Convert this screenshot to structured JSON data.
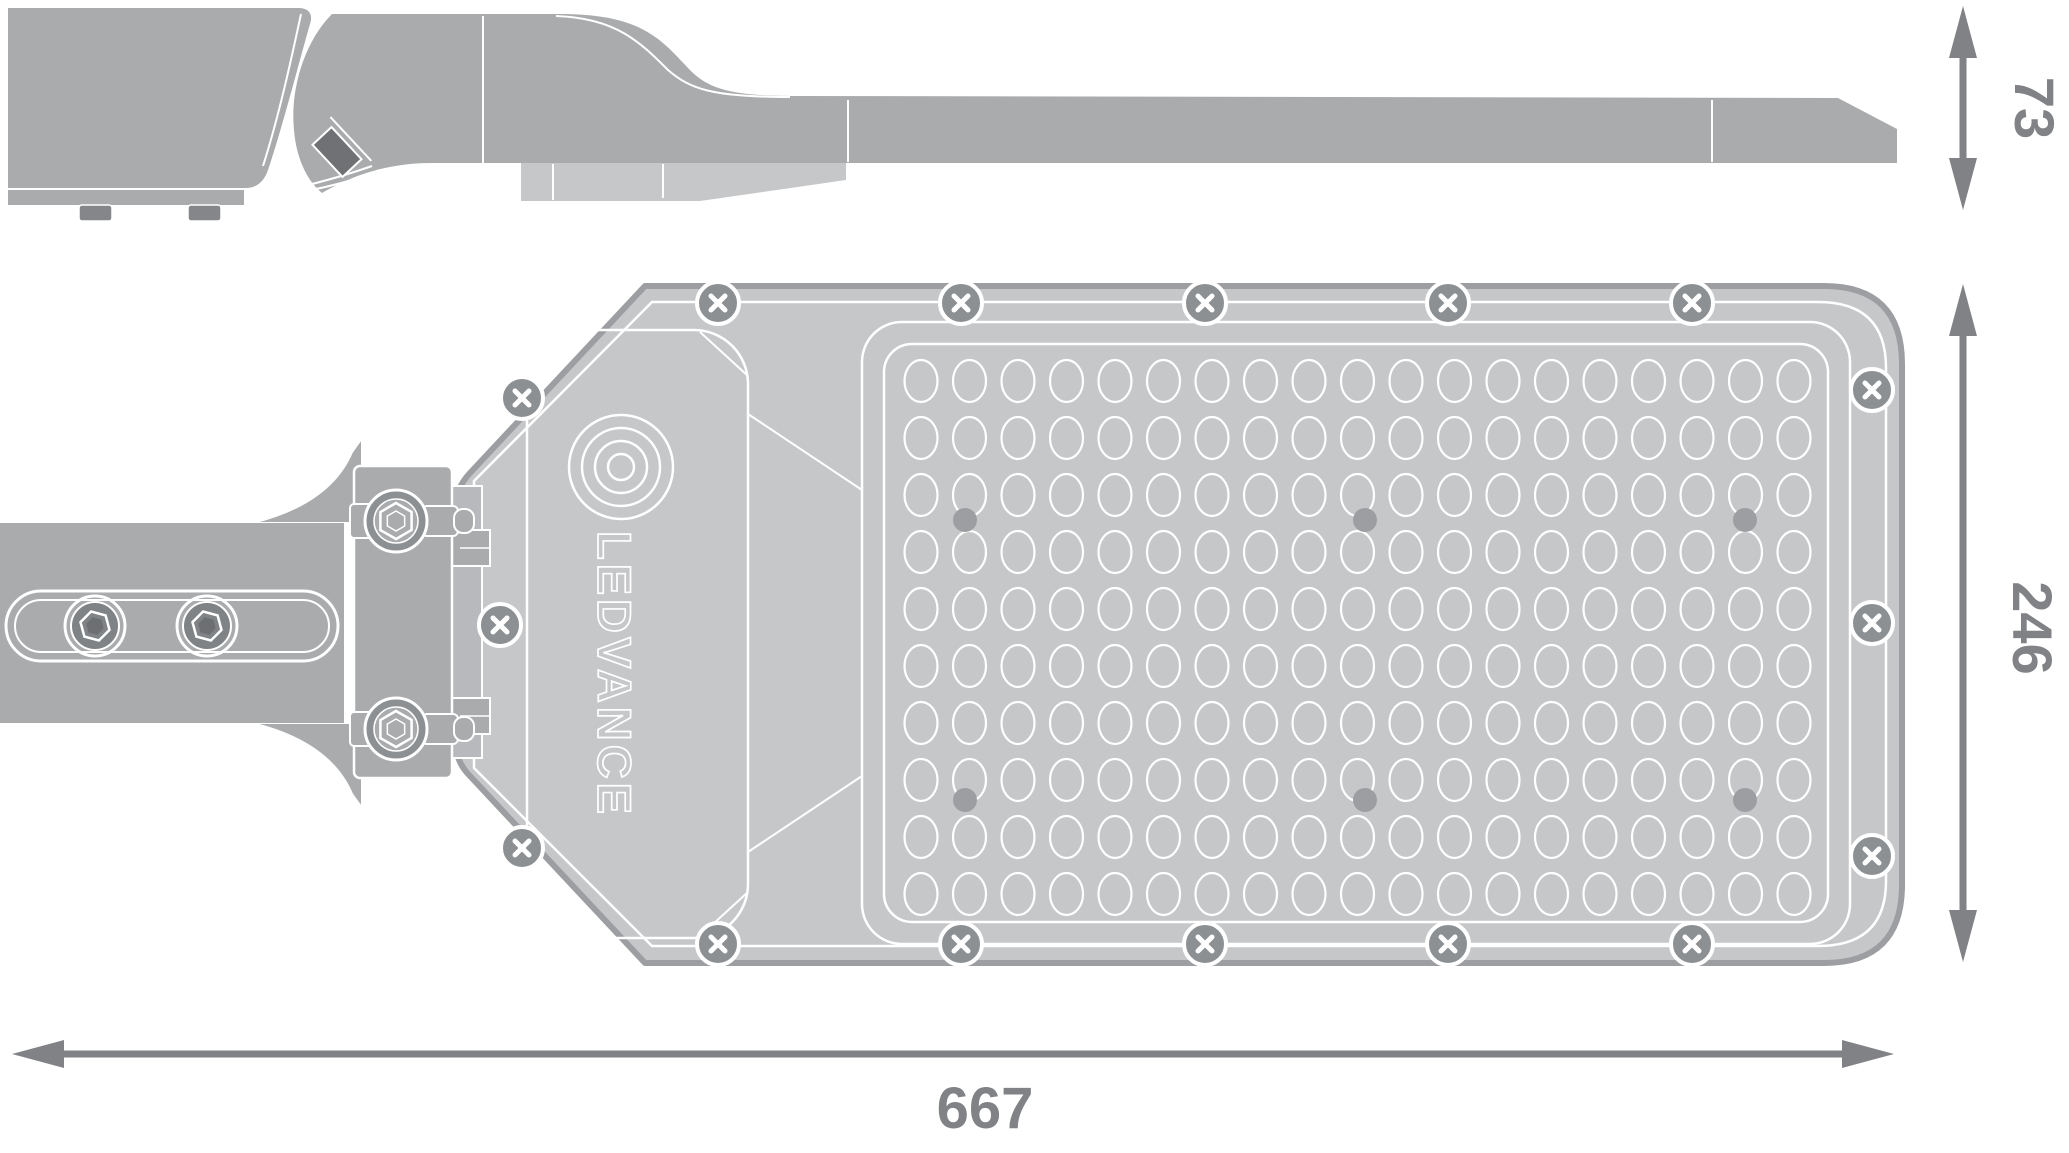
{
  "drawing": {
    "brand_logo": "LEDVANCE",
    "type_label": "street-luminaire dimension drawing"
  },
  "dimensions": {
    "side_height": "73",
    "body_width": "246",
    "total_length": "667"
  },
  "colors": {
    "metal_gray": "#a9abad",
    "body_gray": "#c6c7c9",
    "outline_dark": "#9c9ea1",
    "seam_white": "#ffffff",
    "screw_disc": "#8d9093",
    "hex_dark": "#6c6e71",
    "dark_part": "#6f7174",
    "dimension_gray": "#808285"
  },
  "led_grid": {
    "cols": 19,
    "rows": 10,
    "start_x": 921,
    "start_y": 381,
    "dx": 48.5,
    "dy": 57,
    "rx": 16.5,
    "ry": 21
  },
  "dots": [
    [
      965,
      520
    ],
    [
      1365,
      520
    ],
    [
      1745,
      520
    ],
    [
      965,
      800
    ],
    [
      1365,
      800
    ],
    [
      1745,
      800
    ]
  ],
  "screws": {
    "phillips": [
      [
        718,
        303
      ],
      [
        961,
        303
      ],
      [
        1205,
        303
      ],
      [
        1448,
        303
      ],
      [
        1692,
        303
      ],
      [
        718,
        944
      ],
      [
        961,
        944
      ],
      [
        1205,
        944
      ],
      [
        1448,
        944
      ],
      [
        1692,
        944
      ],
      [
        1872,
        390
      ],
      [
        1872,
        623
      ],
      [
        1872,
        856
      ],
      [
        522,
        398
      ],
      [
        500,
        625
      ],
      [
        522,
        848
      ]
    ],
    "hex_socket": [
      [
        95,
        626
      ],
      [
        207,
        626
      ]
    ],
    "bolts": [
      [
        396,
        521
      ],
      [
        396,
        729
      ]
    ]
  }
}
